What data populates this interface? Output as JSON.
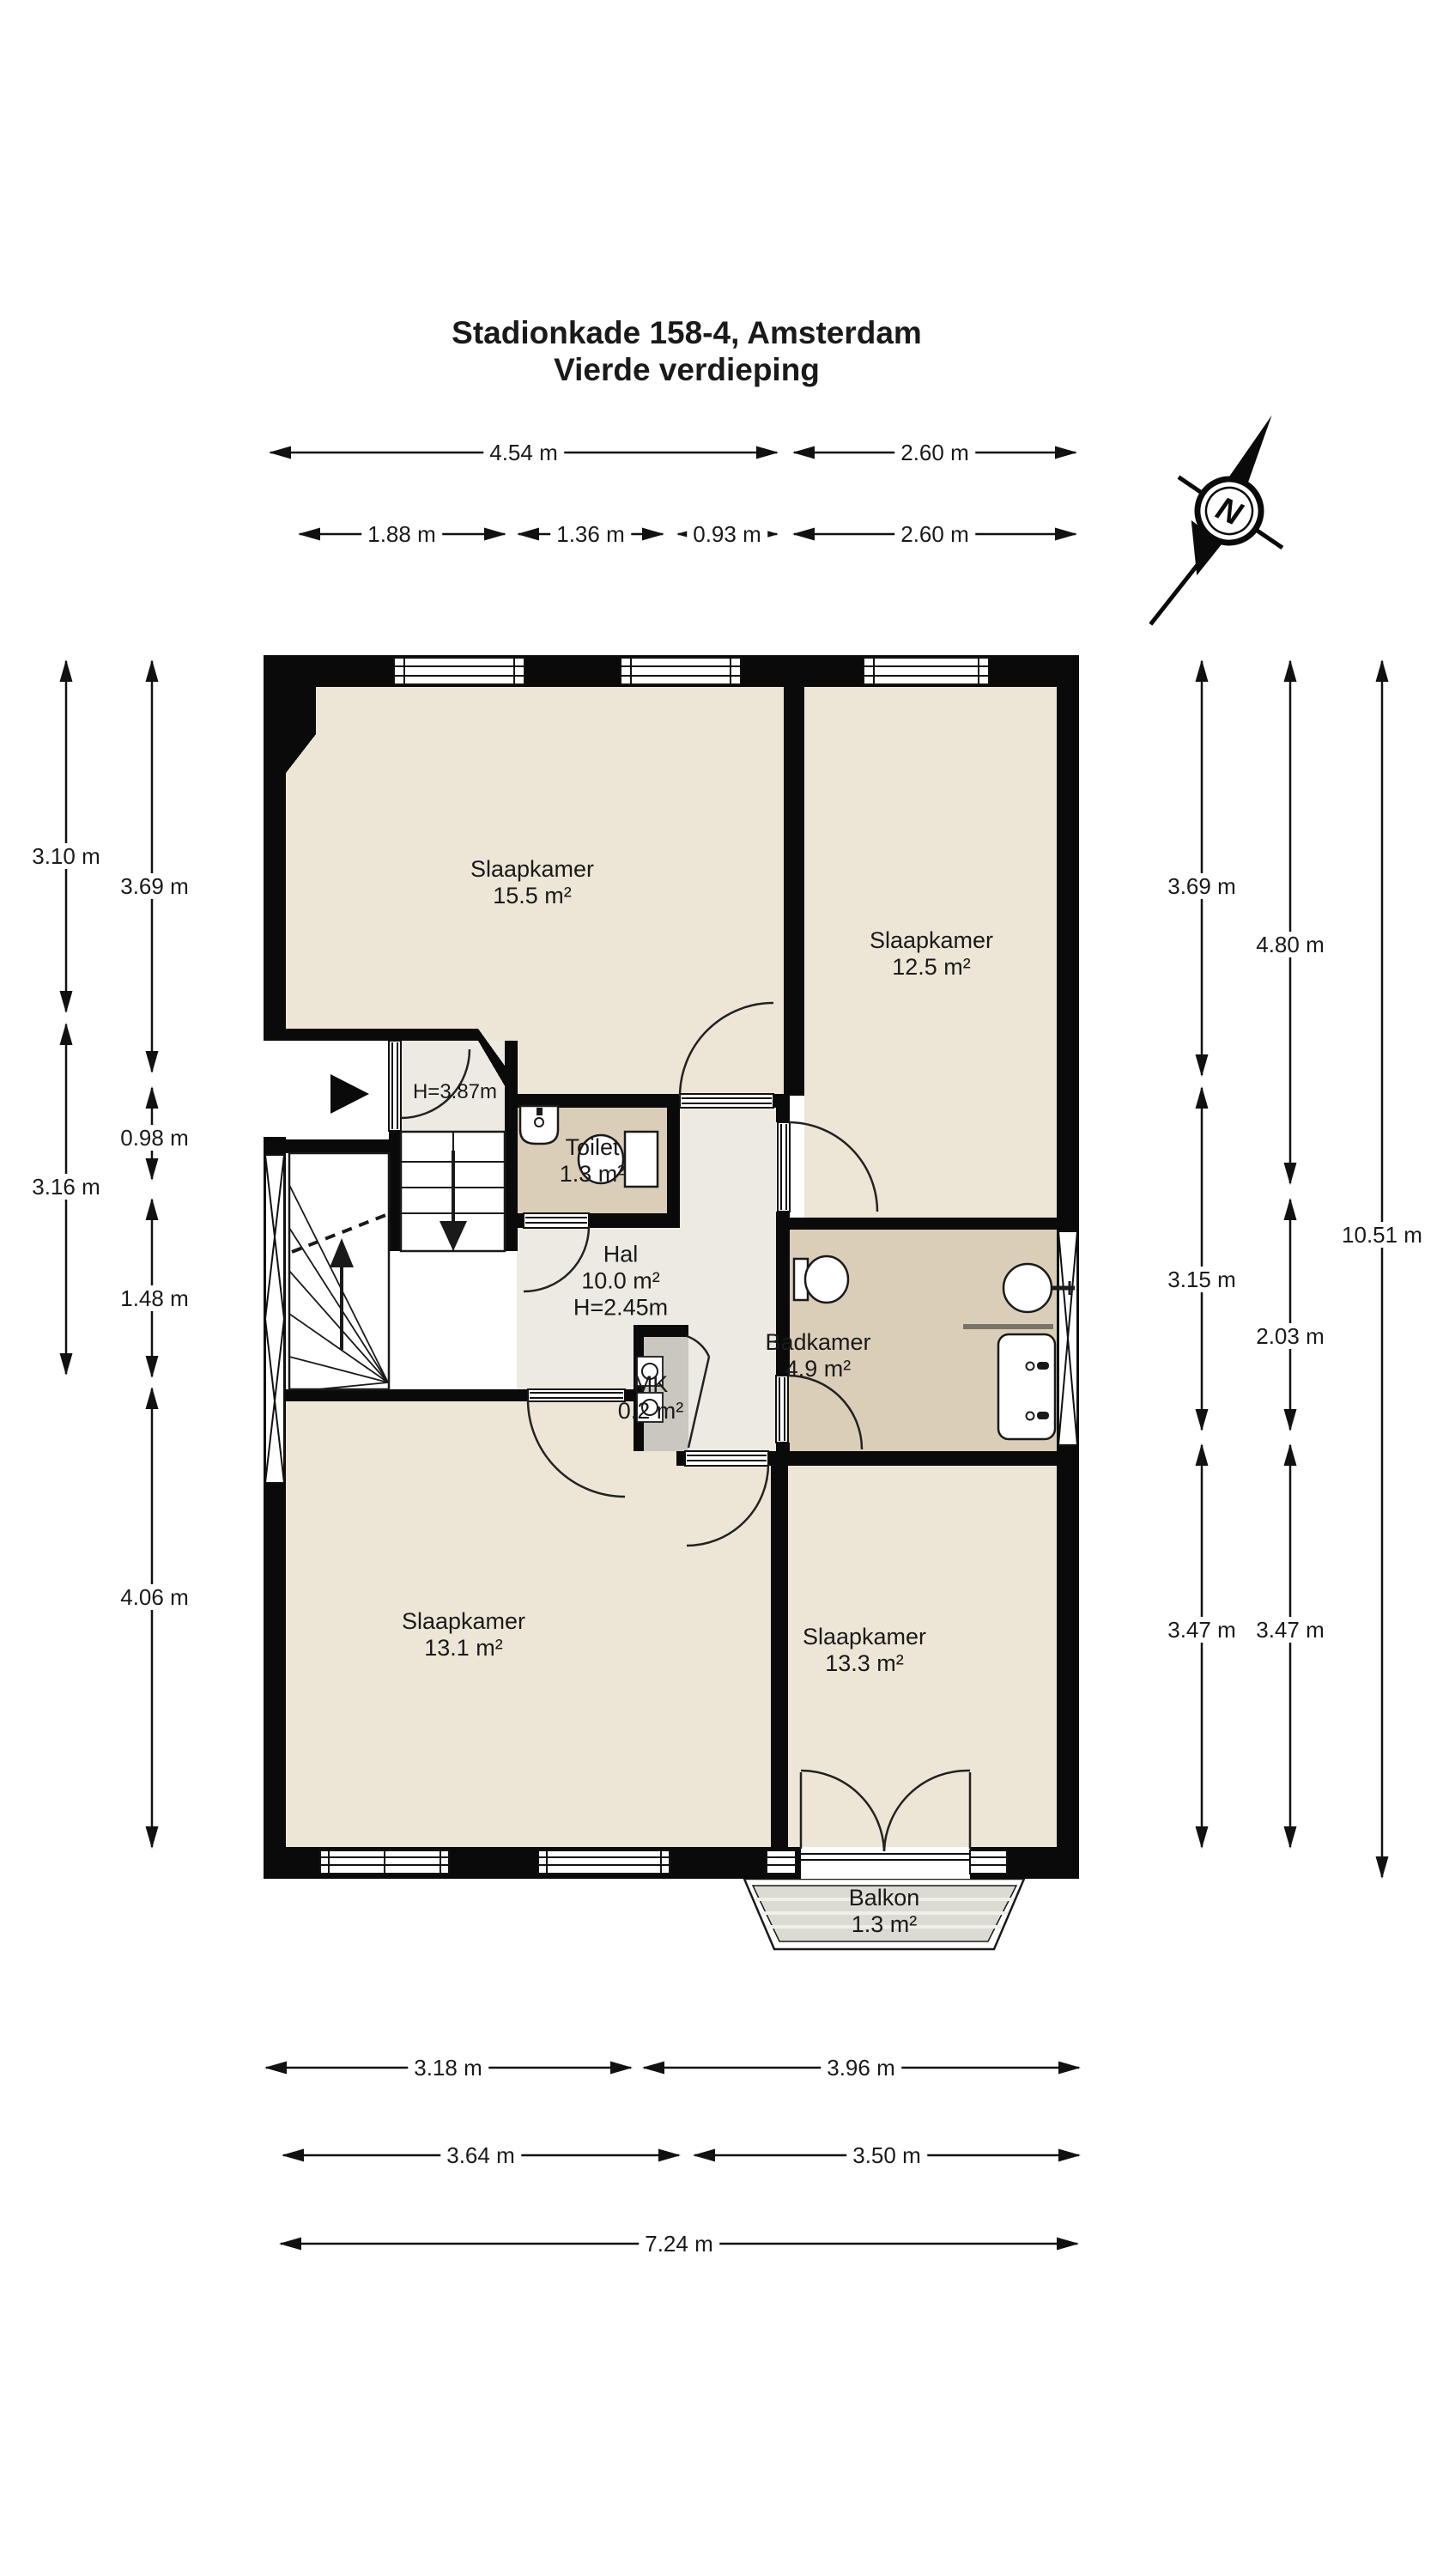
{
  "title": {
    "line1": "Stadionkade 158-4, Amsterdam",
    "line2": "Vierde verdieping"
  },
  "compass": {
    "label": "N"
  },
  "rooms": {
    "slaapkamer_tl": {
      "name": "Slaapkamer",
      "area": "15.5 m²"
    },
    "slaapkamer_tr": {
      "name": "Slaapkamer",
      "area": "12.5 m²"
    },
    "toilet": {
      "name": "Toilet",
      "area": "1.3 m²"
    },
    "hal": {
      "name": "Hal",
      "area": "10.0 m²",
      "height": "H=2.45m"
    },
    "badkamer": {
      "name": "Badkamer",
      "area": "4.9 m²"
    },
    "mk": {
      "name": "MK",
      "area": "0.2 m²"
    },
    "slaapkamer_bl": {
      "name": "Slaapkamer",
      "area": "13.1 m²"
    },
    "slaapkamer_br": {
      "name": "Slaapkamer",
      "area": "13.3 m²"
    },
    "balkon": {
      "name": "Balkon",
      "area": "1.3 m²"
    }
  },
  "annotations": {
    "stair_height": "H=3.87m"
  },
  "dimensions": {
    "top": [
      "4.54 m",
      "2.60 m",
      "1.88 m",
      "1.36 m",
      "0.93 m",
      "2.60 m"
    ],
    "left": [
      "3.10 m",
      "3.16 m",
      "3.69 m",
      "0.98 m",
      "1.48 m",
      "4.06 m"
    ],
    "right": [
      "3.69 m",
      "3.15 m",
      "3.47 m",
      "4.80 m",
      "2.03 m",
      "3.47 m",
      "10.51 m"
    ],
    "bottom": [
      "3.18 m",
      "3.96 m",
      "3.64 m",
      "3.50 m",
      "7.24 m"
    ]
  },
  "colors": {
    "wall": "#0a0a0a",
    "room_beige": "#EDE6D6",
    "wet_room_tan": "#DBCEB9",
    "hal_gray": "#ECEAE2",
    "mk_gray": "#C9C7C0",
    "balkon_gray": "#DCDBD3",
    "text": "#1a1a1a"
  }
}
